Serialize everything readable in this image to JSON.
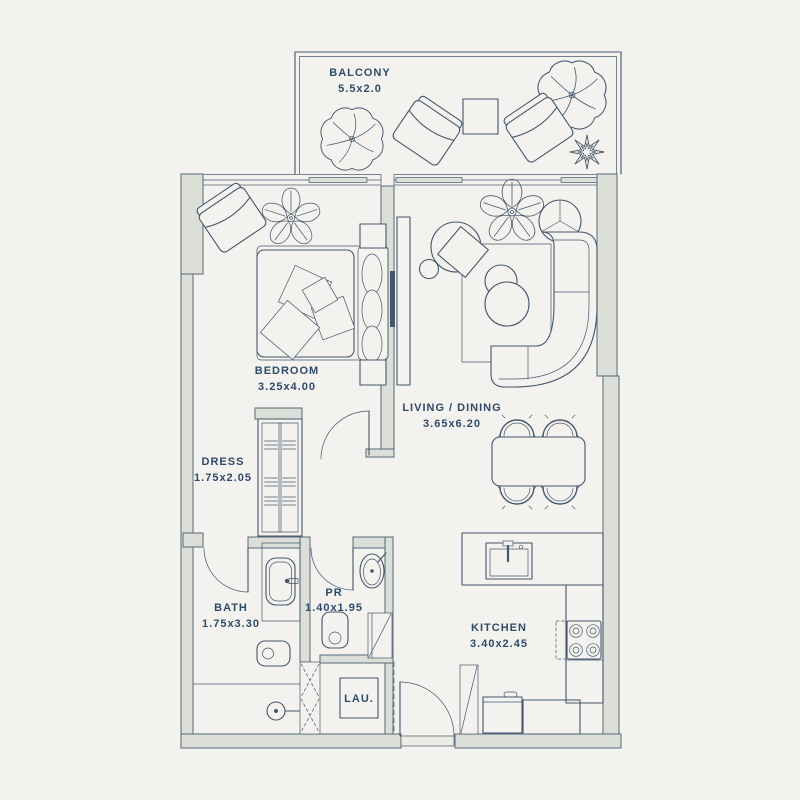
{
  "plan_title": "One-bedroom apartment floor plan",
  "colors": {
    "background": "#f4f2ee",
    "wall_fill": "#dcdfd8",
    "line": "#44576c",
    "text": "#2e4b6b"
  },
  "rooms": {
    "balcony": {
      "label": "BALCONY",
      "dims": "5.5x2.0"
    },
    "bedroom": {
      "label": "BEDROOM",
      "dims": "3.25x4.00"
    },
    "living": {
      "label": "LIVING / DINING",
      "dims": "3.65x6.20"
    },
    "dress": {
      "label": "DRESS",
      "dims": "1.75x2.05"
    },
    "bath": {
      "label": "BATH",
      "dims": "1.75x3.30"
    },
    "pr": {
      "label": "PR",
      "dims": "1.40x1.95"
    },
    "kitchen": {
      "label": "KITCHEN",
      "dims": "3.40x2.45"
    },
    "laundry": {
      "label": "LAU."
    }
  }
}
